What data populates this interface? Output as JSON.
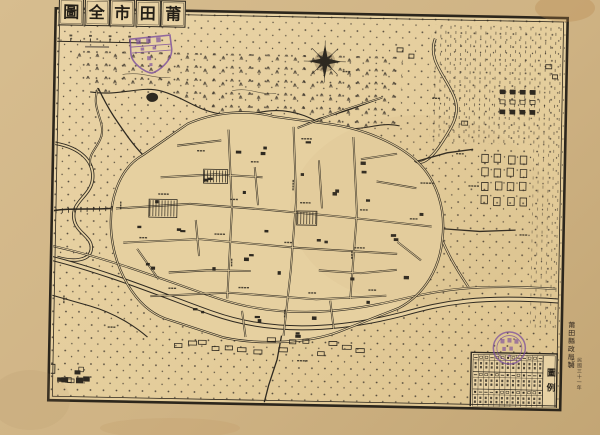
{
  "map": {
    "title": {
      "text_rtl": "莆田市全圖",
      "chars": [
        "圖",
        "全",
        "市",
        "田",
        "莆"
      ]
    },
    "legend": {
      "title": "圖例"
    },
    "imprint": {
      "publisher": "莆田縣政局製",
      "date": "民國三十一年七月"
    },
    "compass": {
      "name": "compass-rose"
    },
    "colors": {
      "paper": "#cfb384",
      "sheet": "#e5cf9e",
      "ink": "#2e2920",
      "stamp": "#7b4e9d"
    }
  }
}
